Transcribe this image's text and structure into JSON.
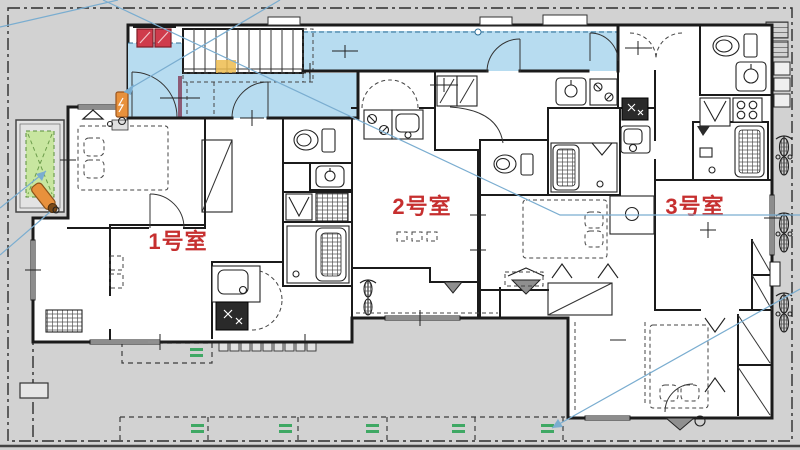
{
  "plan": {
    "kind": "apartment-floor-plan",
    "rooms": [
      {
        "id": "room-1",
        "label": "1号室"
      },
      {
        "id": "room-2",
        "label": "2号室"
      },
      {
        "id": "room-3",
        "label": "3号室"
      }
    ],
    "features": [
      "common-corridor",
      "staircase",
      "bicycle-parking-space",
      "parking-stalls",
      "entrance-doors",
      "annotation-leader-lines"
    ],
    "fixture_icons": [
      "toilet-icon",
      "bathtub-icon",
      "kitchen-sink-icon",
      "gas-stove-icon",
      "washbasin-icon",
      "washing-machine-icon",
      "bed-outline",
      "closet",
      "bicycle-icon",
      "meter-box-icon",
      "fire-alarm-box-icon",
      "gas-meter-icon",
      "safety-cone-icon",
      "stepping-stones"
    ]
  },
  "theme": {
    "siteGray": "#d2d2d2",
    "corridorBlue": "#b7dcf0",
    "wallColor": "#1b1b1b",
    "labelRed": "#c62f2f",
    "parkGreen": "#3fa864",
    "bikeSpaceGreen": "#c8e6a0",
    "alertRed": "#cf3b4c",
    "meterOrange": "#e8913c",
    "stairHighlight": "#edbc4f",
    "annBlue": "#7aadd0"
  }
}
